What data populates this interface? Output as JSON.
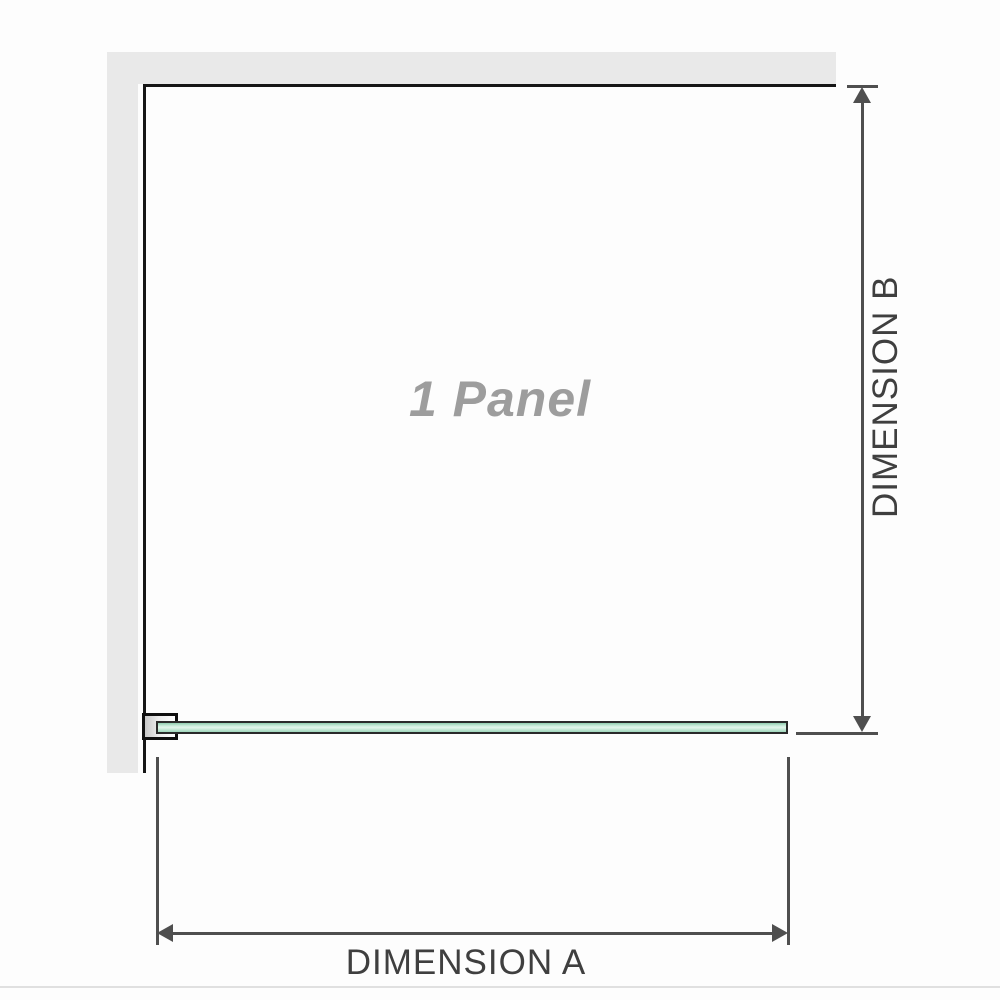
{
  "diagram": {
    "title": "1 Panel",
    "panel_watermark": "1 Panel",
    "dimension_a": {
      "label": "DIMENSION A",
      "measures": "panel width"
    },
    "dimension_b": {
      "label": "DIMENSION B",
      "measures": "panel depth from back wall"
    },
    "elements": {
      "wall": "L-shaped wall (top and left), plan view",
      "glass_panel": "single fixed glass panel, plan view",
      "wall_bracket": "wall-mount glass clamp at left end of panel"
    }
  },
  "colors": {
    "background": "#fdfdfd",
    "wall_fill": "#e9e9e9",
    "wall_line": "#161616",
    "glass_border": "#2a2a2a",
    "glass_green_light": "#e3f5ec",
    "glass_green": "#8fccaf",
    "dimension_line": "#4f4f4f",
    "dimension_text": "#3f3f3f",
    "watermark_text": "#9d9d9d",
    "divider": "#e0e0e0"
  },
  "icons": {
    "arrow_up": "solid triangle arrowhead pointing up",
    "arrow_down": "solid triangle arrowhead pointing down",
    "arrow_left": "solid triangle arrowhead pointing left",
    "arrow_right": "solid triangle arrowhead pointing right"
  }
}
